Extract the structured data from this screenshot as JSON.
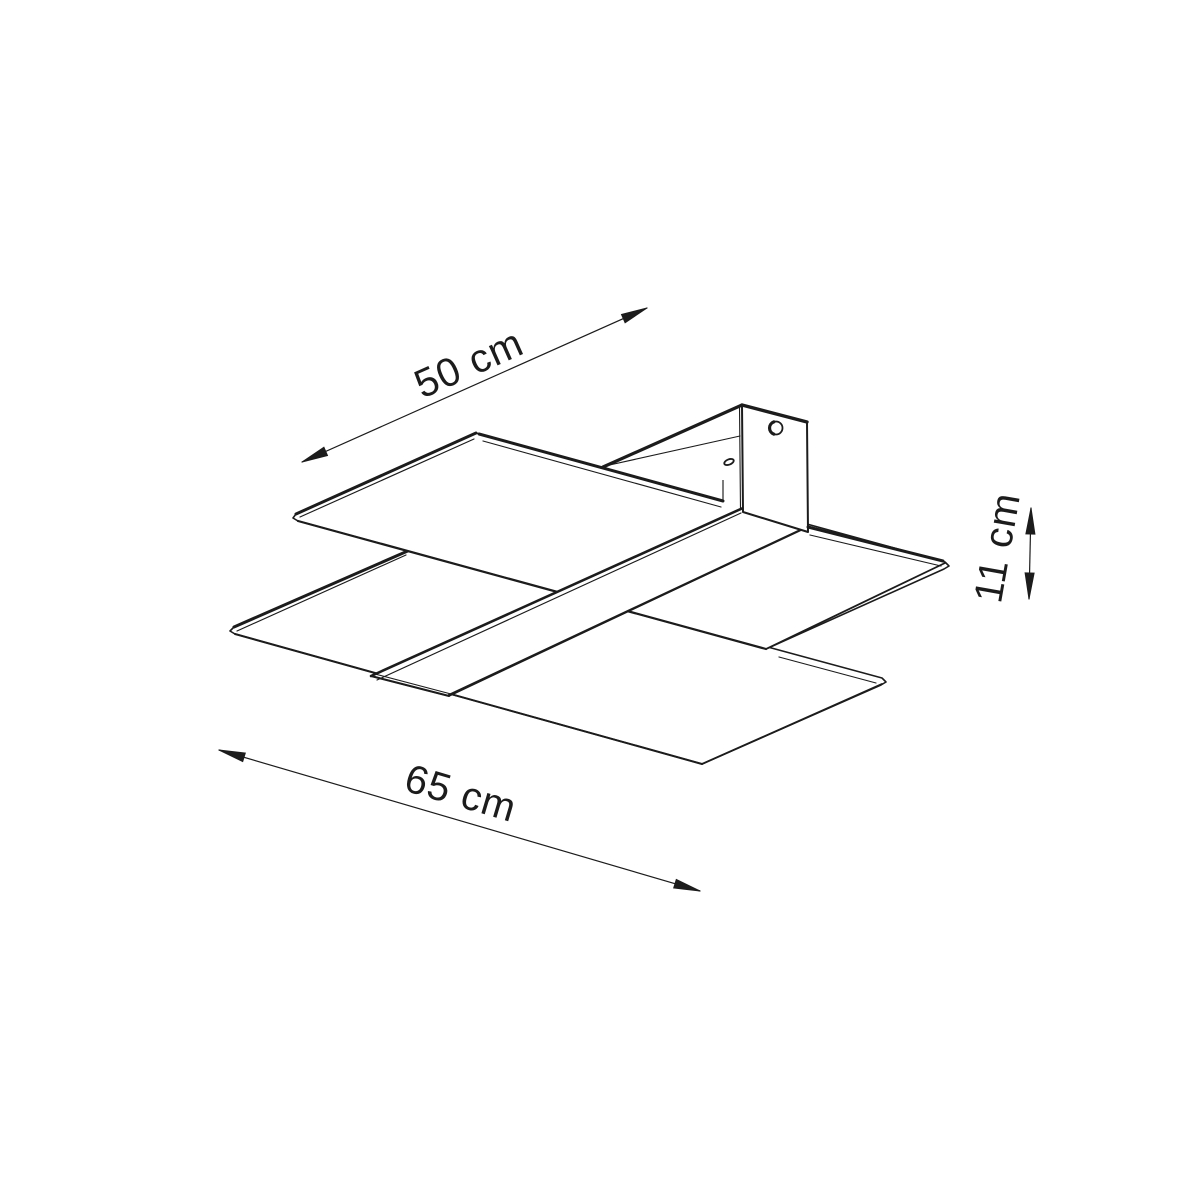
{
  "page": {
    "background": "#ffffff",
    "line_color": "#1c1c1c"
  },
  "drawing": {
    "dimensions": {
      "depth": {
        "label": "50 cm"
      },
      "width": {
        "label": "65 cm"
      },
      "height": {
        "label": "11 cm"
      }
    }
  }
}
